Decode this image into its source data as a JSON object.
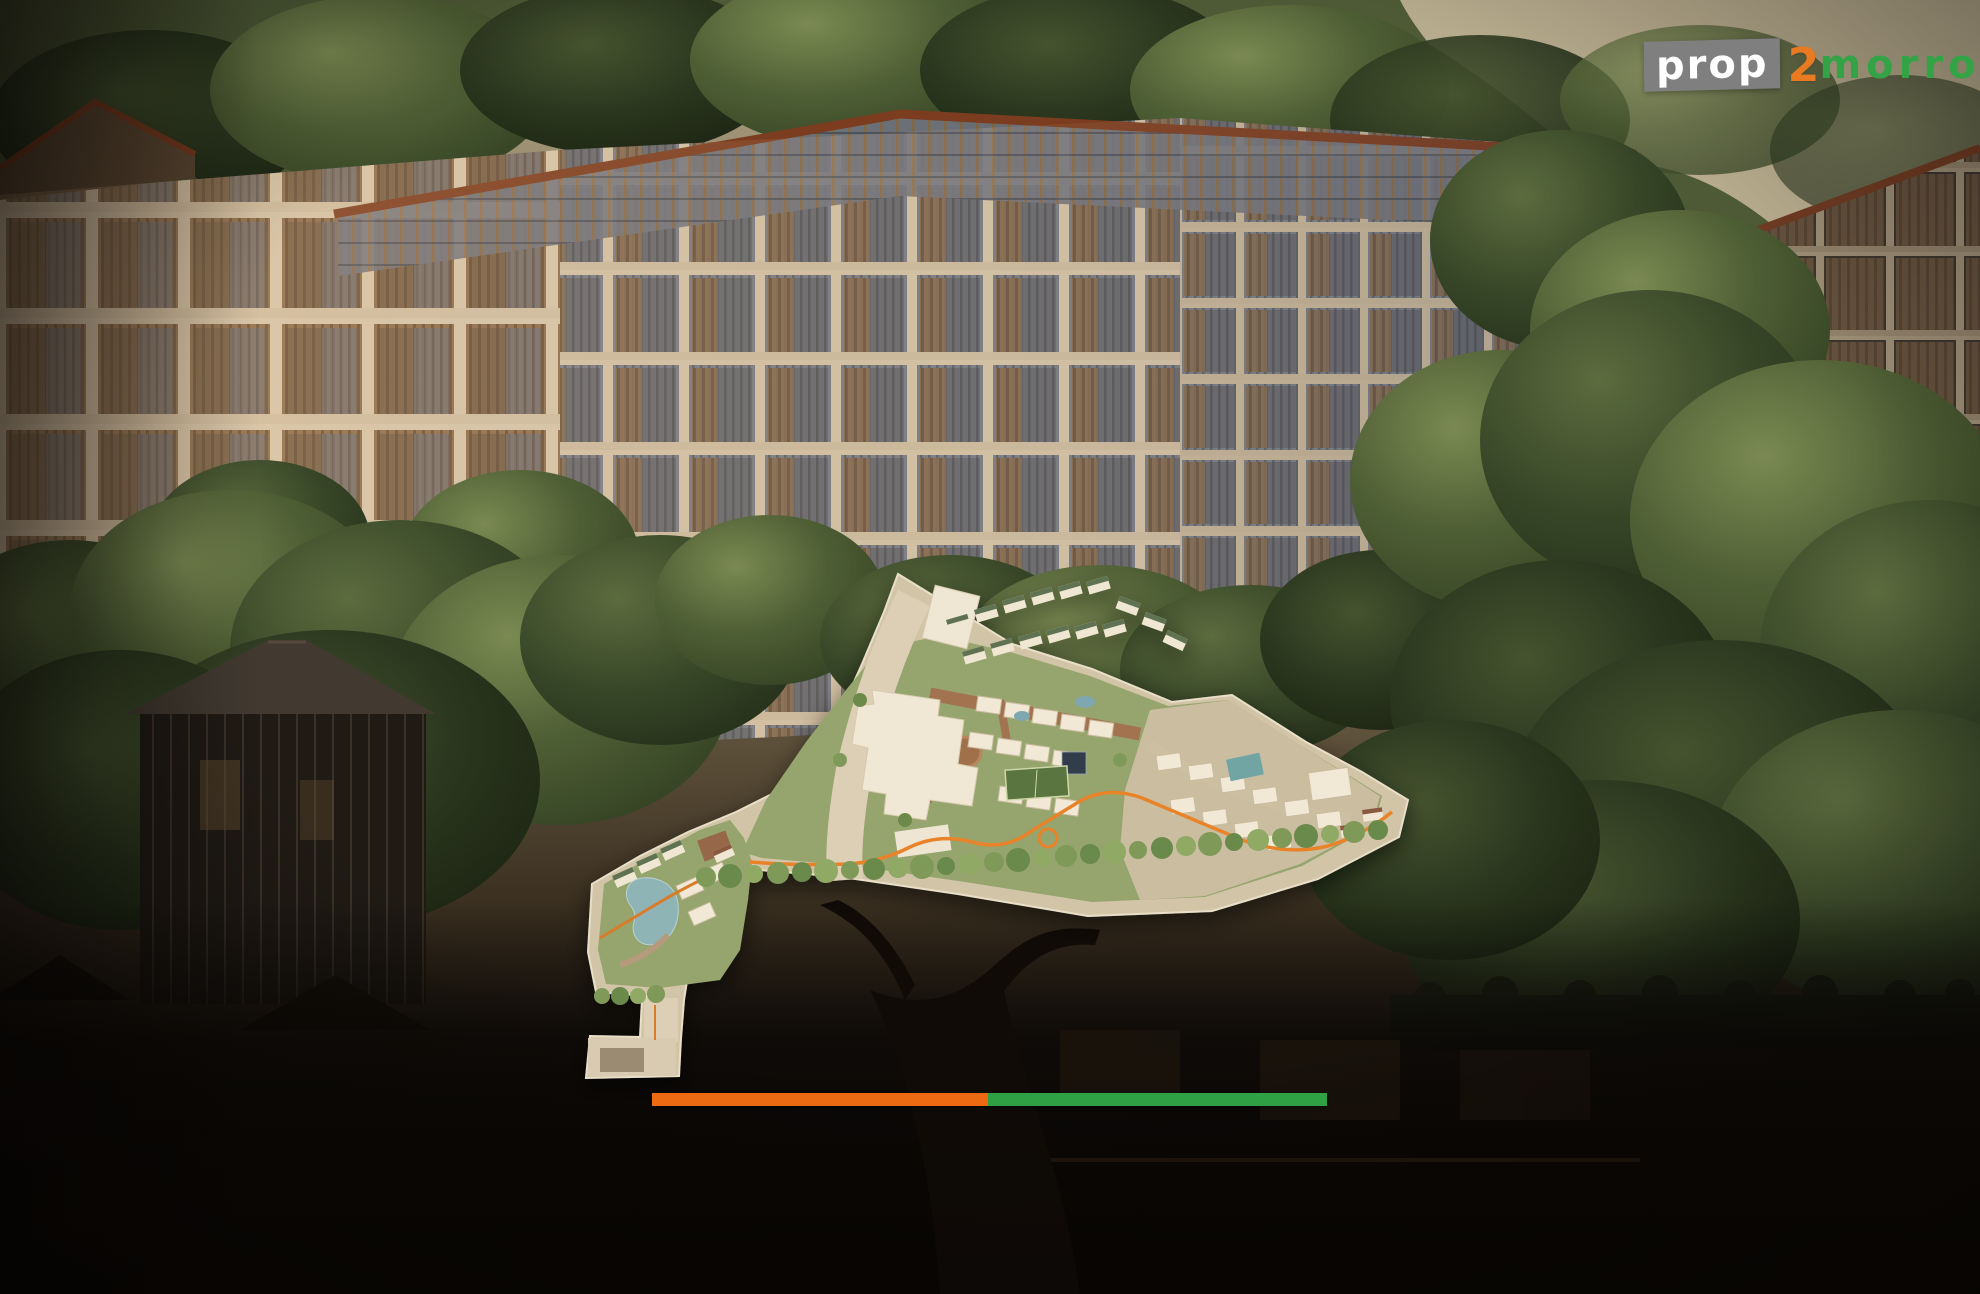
{
  "logo": {
    "text_prop": "prop",
    "text_2": "2",
    "text_morrow": "morrow"
  },
  "colors": {
    "logo-box": "#7f7f7f",
    "logo-prop": "#ffffff",
    "logo-2": "#e87b22",
    "logo-morrow": "#33a346",
    "bar-orange": "#ed6a13",
    "bar-green": "#2fa044"
  },
  "footer_bar": {
    "orange_fraction": 0.498,
    "green_fraction": 0.502
  }
}
